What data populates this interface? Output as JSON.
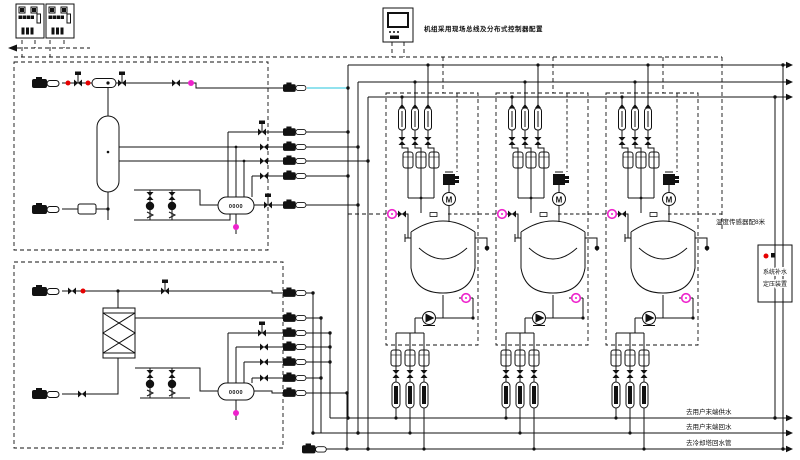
{
  "diagram": {
    "kind": "HVAC / process plant P&ID schematic",
    "hmi_note": "机组采用现场总线及分布式控制器配置",
    "sensor_note": "温度传感器配8米",
    "pressurization_box": {
      "line1": "系统补水",
      "line2": "定压装置"
    },
    "pipe_labels": [
      "去用户末端供水",
      "去用户末端回水",
      "去冷却塔回水管"
    ],
    "oval_vessel_text": "0000",
    "motor_label": "M",
    "reactor_count": 3,
    "control_cabinet_count": 2,
    "colors": {
      "line": "#111111",
      "valve_red": "#e60000",
      "instrument_magenta": "#ee22cc",
      "pipe_cyan": "#6fd8e8",
      "background": "#ffffff"
    }
  }
}
